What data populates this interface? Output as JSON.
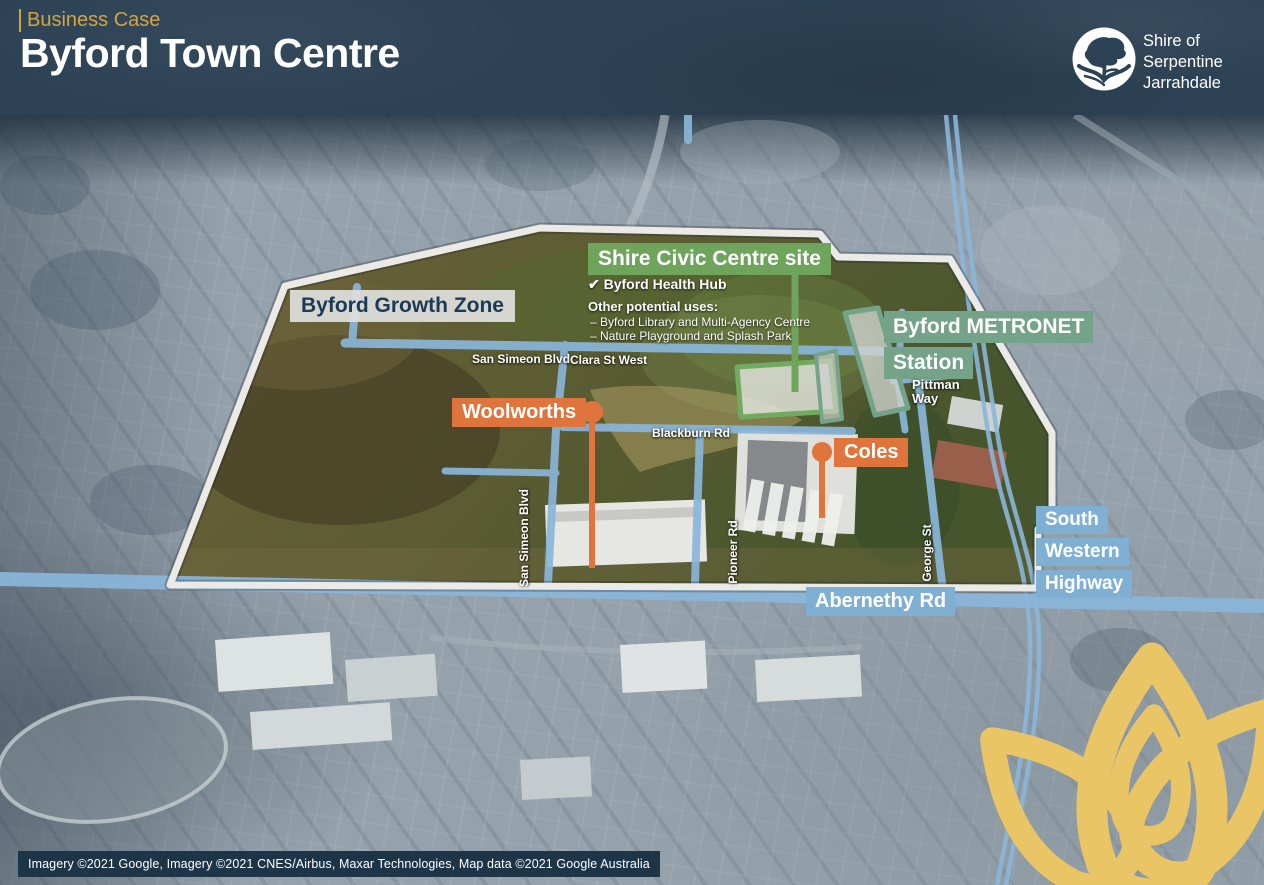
{
  "header": {
    "eyebrow": "Business Case",
    "title": "Byford Town Centre",
    "org": [
      "Shire of",
      "Serpentine",
      "Jarrahdale"
    ]
  },
  "labels": {
    "growth_zone": "Byford Growth Zone",
    "civic_site": "Shire Civic Centre site",
    "civic_check": "Byford Health Hub",
    "civic_other_heading": "Other potential uses:",
    "civic_other_1": "–  Byford Library and Multi-Agency Centre",
    "civic_other_2": "–  Nature Playground and Splash Park",
    "metronet_1": "Byford METRONET",
    "metronet_2": "Station",
    "woolworths": "Woolworths",
    "coles": "Coles",
    "swh_1": "South",
    "swh_2": "Western",
    "swh_3": "Highway",
    "abernethy": "Abernethy Rd"
  },
  "roads": {
    "san_simeon_h": "San Simeon Blvd",
    "clara": "Clara St West",
    "blackburn": "Blackburn Rd",
    "pittman_1": "Pittman",
    "pittman_2": "Way",
    "san_simeon_v": "San Simeon Blvd",
    "pioneer": "Pioneer Rd",
    "george": "George St"
  },
  "icons": {
    "check": "✔"
  },
  "attribution": "Imagery ©2021 Google, Imagery ©2021 CNES/Airbus, Maxar Technologies, Map data ©2021 Google Australia",
  "colors": {
    "header_bg": "#2d4255",
    "accent_gold": "#d3a443",
    "label_green": "#6fa45c",
    "label_sage": "#74a389",
    "label_orange": "#e0743d",
    "road_blue": "#8ab6da",
    "label_blue": "#7fb0d4",
    "boundary_white": "#ebeae6",
    "lotus_gold": "#e9c566"
  }
}
